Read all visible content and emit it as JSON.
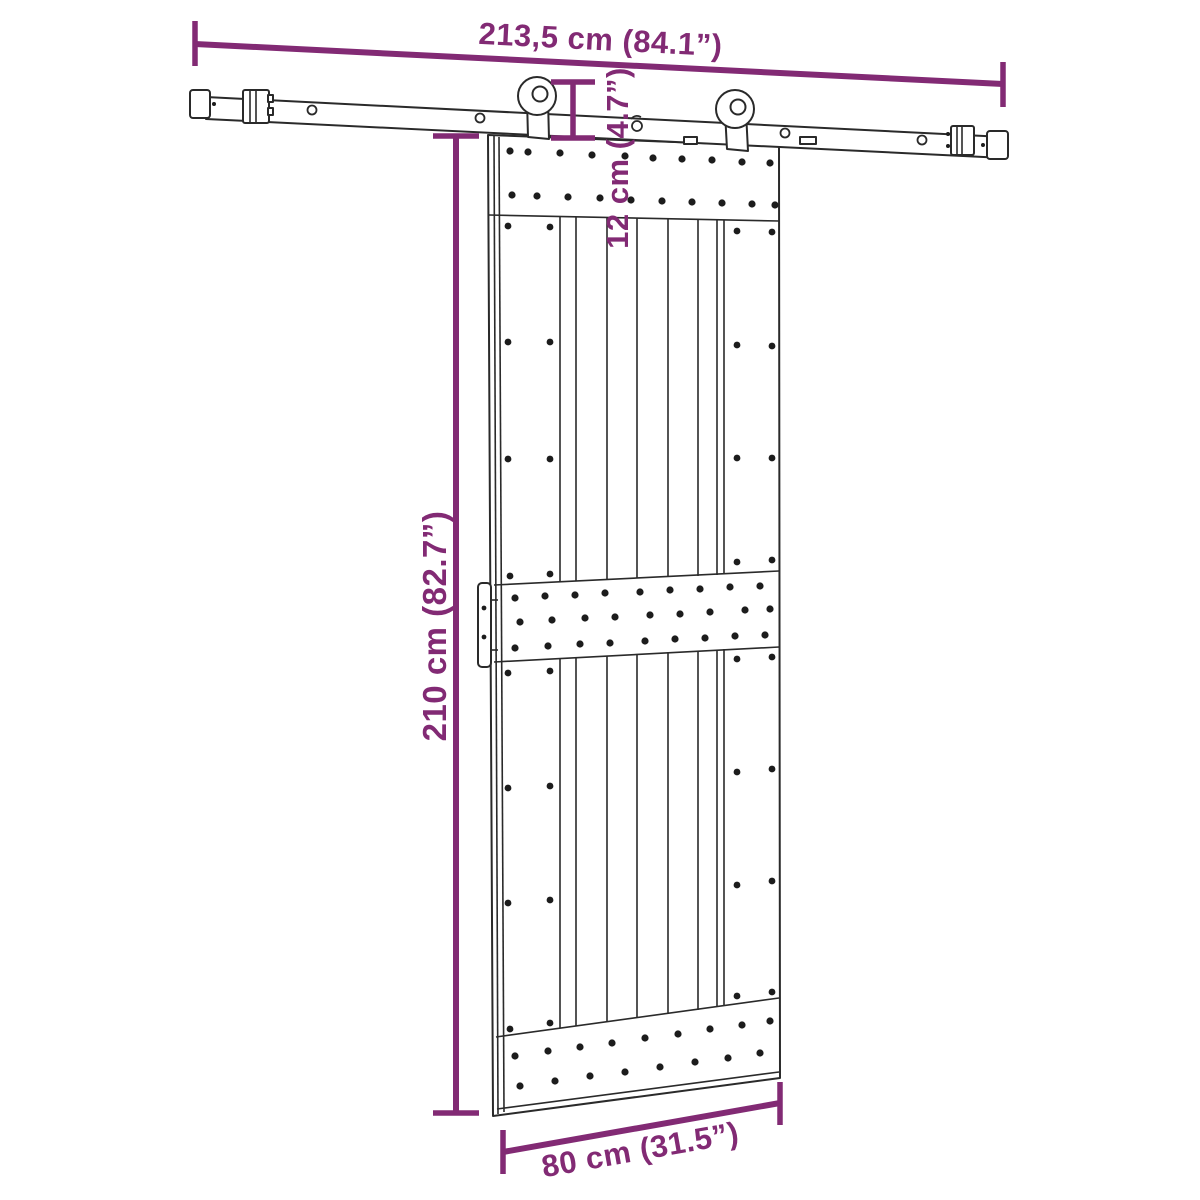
{
  "diagram": {
    "accent_color": "#822A74",
    "line_color": "#2a2a2a",
    "background": "#ffffff",
    "dimensions": {
      "track_length_label": "213,5 cm (84.1”)",
      "top_offset_label": "12 cm (4.7”)",
      "door_height_label": "210 cm (82.7”)",
      "door_width_label": "80 cm (31.5”)"
    }
  }
}
